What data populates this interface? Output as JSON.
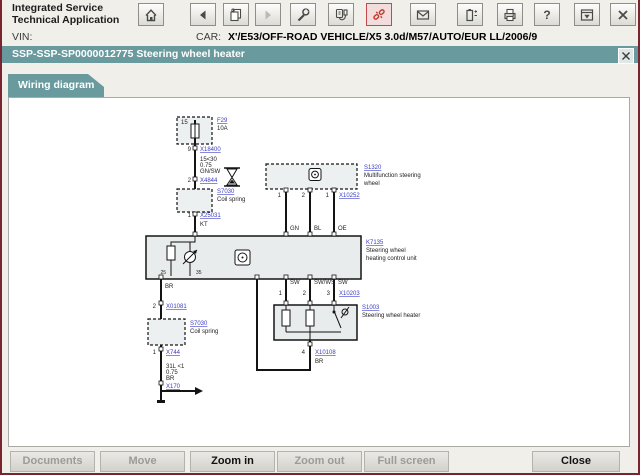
{
  "window": {
    "title_line1": "Integrated Service",
    "title_line2": "Technical Application"
  },
  "toolbar": {
    "help_glyph": "?",
    "icons": [
      "home",
      "back",
      "copy-documents",
      "forward",
      "wrench",
      "diagnostic-plug",
      "broken-connection",
      "mail",
      "battery",
      "printer",
      "help",
      "window-down",
      "close"
    ]
  },
  "vehicle_bar": {
    "vin_label": "VIN:",
    "vin_value": "",
    "car_label": "CAR:",
    "car_value": "X'/E53/OFF-ROAD VEHICLE/X5 3.0d/M57/AUTO/EUR LL/2006/9"
  },
  "document_bar": {
    "title": "SSP-SSP-SP0000012775 Steering wheel heater"
  },
  "tab": {
    "label": "Wiring diagram"
  },
  "diagram": {
    "fuse": {
      "pin_top": "15",
      "code": "F29",
      "rating": "10A",
      "pin_out": "9",
      "connector_1": "X18400",
      "wire_circuit": "15<30",
      "wire_size": "0.75",
      "wire_color": "GN/SW",
      "pin_2": "2",
      "connector_2": "X4844"
    },
    "coil_spring_upper": {
      "code": "S7030",
      "label": "Coil spring",
      "pin": "1",
      "connector": "X25031",
      "wire": "KT"
    },
    "multifunction_steering_wheel": {
      "code": "S1320",
      "label_line1": "Multifunction steering",
      "label_line2": "wheel",
      "pin_1": "1",
      "pin_2": "2",
      "pin_3": "1",
      "connector": "X10252",
      "wire_1": "GN",
      "wire_2": "BL",
      "wire_3": "OE"
    },
    "control_unit": {
      "code": "K7135",
      "label_line1": "Steering wheel",
      "label_line2": "heating control unit",
      "pin_a": "25",
      "pin_b": "35",
      "wire_out": "BR"
    },
    "heater": {
      "code": "S1003",
      "label": "Steering wheel heater",
      "wire_1": "SW",
      "wire_2": "SW/WS",
      "wire_3": "SW",
      "pin_1": "1",
      "pin_2": "2",
      "pin_3": "3",
      "connector_top": "X10203",
      "pin_4": "4",
      "connector_bottom": "X10108",
      "wire_4": "BR"
    },
    "coil_spring_lower": {
      "code": "S7030",
      "label": "Coil spring",
      "pin_in": "2",
      "connector_in": "X01081",
      "pin_out": "1",
      "connector_out": "X744",
      "wire_circuit": "31L <1",
      "wire_size": "0.75",
      "wire_color": "BR",
      "ground_connector": "X170"
    }
  },
  "footer": {
    "buttons": [
      {
        "label": "Documents",
        "enabled": false
      },
      {
        "label": "Move",
        "enabled": false
      },
      {
        "label": "Zoom in",
        "enabled": true
      },
      {
        "label": "Zoom out",
        "enabled": false
      },
      {
        "label": "Full screen",
        "enabled": false
      },
      {
        "label": "Close",
        "enabled": true
      }
    ]
  },
  "colors": {
    "teal": "#689a9e",
    "window_border": "#7a2430",
    "link": "#3b3bc4",
    "alert": "#c0392b"
  }
}
